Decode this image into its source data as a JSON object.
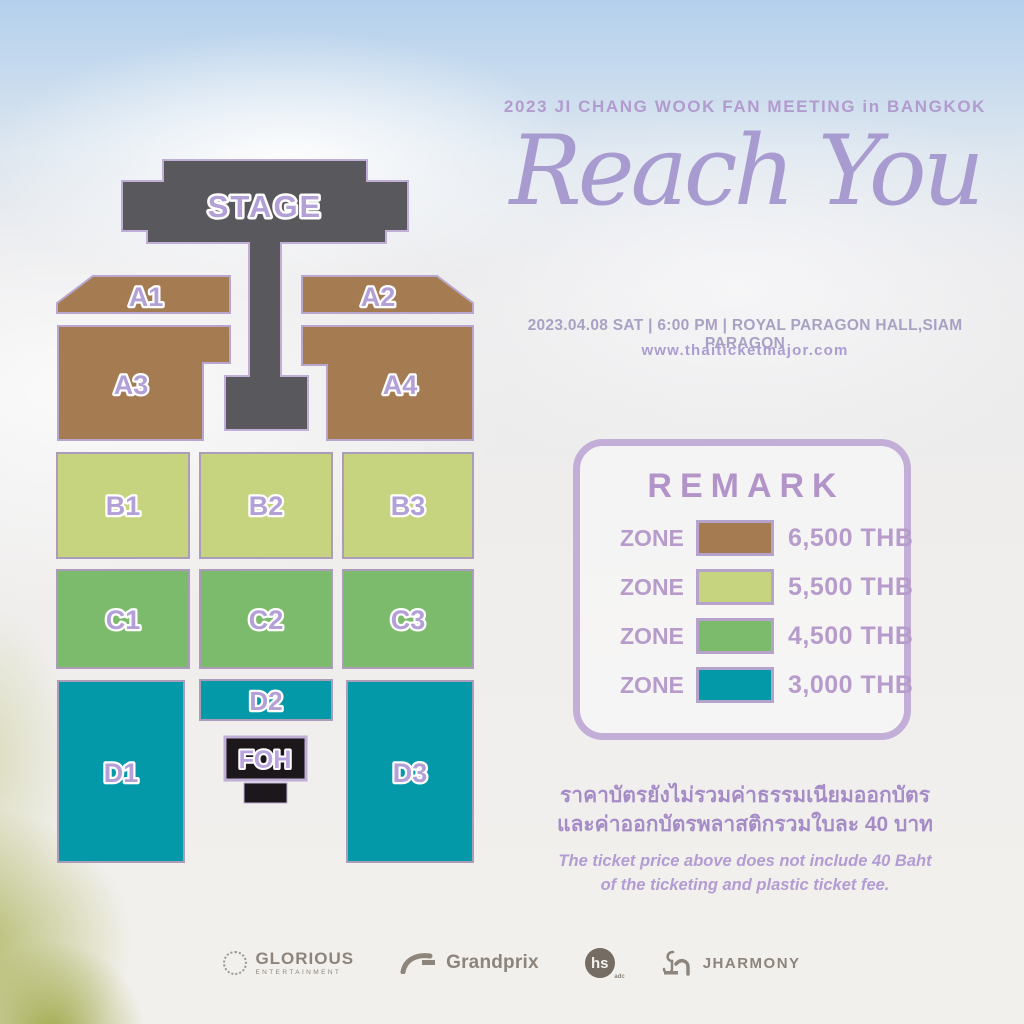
{
  "header": {
    "title": "2023 JI CHANG WOOK FAN MEETING in BANGKOK",
    "logo_script": "Reach You",
    "date_line": "2023.04.08 SAT | 6:00 PM | ROYAL PARAGON HALL,SIAM PARAGON",
    "website": "www.thaiticketmajor.com"
  },
  "colors": {
    "zone_a": "#a57c52",
    "zone_b": "#c6d37f",
    "zone_c": "#7cba6c",
    "zone_d": "#0399a8",
    "stage": "#59585c",
    "foh": "#1c171a",
    "accent_border": "#bca9d4",
    "label_text": "#b2a0d6"
  },
  "seat_map": {
    "stage_label": "STAGE",
    "foh_label": "FOH",
    "zones": [
      {
        "label": "A1",
        "category": "A"
      },
      {
        "label": "A2",
        "category": "A"
      },
      {
        "label": "A3",
        "category": "A"
      },
      {
        "label": "A4",
        "category": "A"
      },
      {
        "label": "B1",
        "category": "B"
      },
      {
        "label": "B2",
        "category": "B"
      },
      {
        "label": "B3",
        "category": "B"
      },
      {
        "label": "C1",
        "category": "C"
      },
      {
        "label": "C2",
        "category": "C"
      },
      {
        "label": "C3",
        "category": "C"
      },
      {
        "label": "D1",
        "category": "D"
      },
      {
        "label": "D2",
        "category": "D"
      },
      {
        "label": "D3",
        "category": "D"
      }
    ]
  },
  "remark": {
    "title": "REMARK",
    "rows": [
      {
        "label": "ZONE",
        "color": "#a57c52",
        "price": "6,500 THB"
      },
      {
        "label": "ZONE",
        "color": "#c6d37f",
        "price": "5,500 THB"
      },
      {
        "label": "ZONE",
        "color": "#7cba6c",
        "price": "4,500 THB"
      },
      {
        "label": "ZONE",
        "color": "#0399a8",
        "price": "3,000 THB"
      }
    ]
  },
  "notes": {
    "thai_line1": "ราคาบัตรยังไม่รวมค่าธรรมเนียมออกบัตร",
    "thai_line2": "และค่าออกบัตรพลาสติกรวมใบละ 40 บาท",
    "english_line1": "The ticket price above does not include 40 Baht",
    "english_line2": "of the ticketing and plastic ticket fee."
  },
  "sponsors": [
    {
      "name": "GLORIOUS",
      "subtext": "ENTERTAINMENT"
    },
    {
      "name": "Grandprix"
    },
    {
      "name": "hs",
      "subtext": "adc"
    },
    {
      "name": "JHARMONY"
    }
  ]
}
